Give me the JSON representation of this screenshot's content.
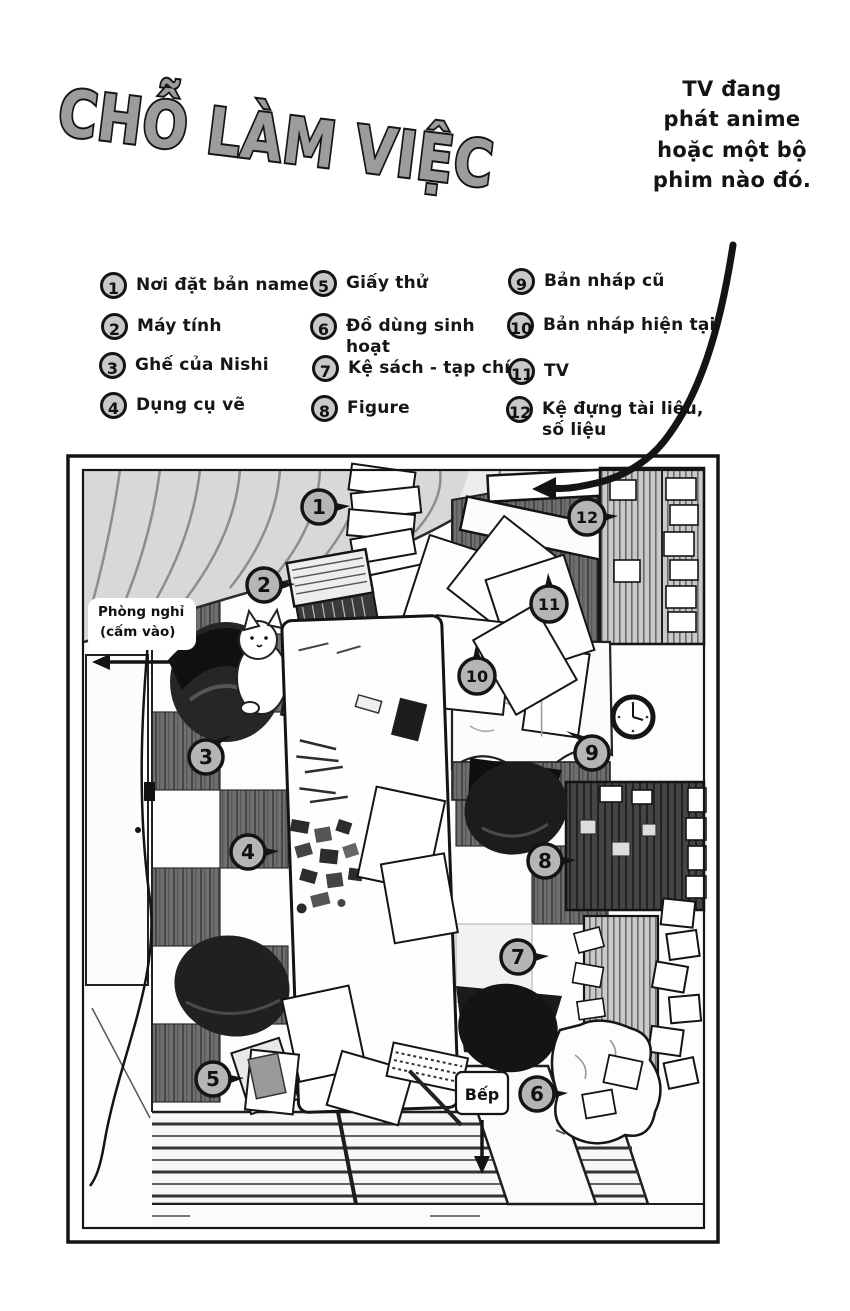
{
  "page": {
    "title": "CHỖ LÀM VIỆC",
    "annotation": "TV đang\nphát anime\nhoặc một bộ\nphim nào đó."
  },
  "legend": {
    "items": [
      {
        "num": "1",
        "label": "Nơi đặt bản name"
      },
      {
        "num": "2",
        "label": "Máy tính"
      },
      {
        "num": "3",
        "label": "Ghế của Nishi"
      },
      {
        "num": "4",
        "label": "Dụng cụ vẽ"
      },
      {
        "num": "5",
        "label": "Giấy thử"
      },
      {
        "num": "6",
        "label": "Đồ dùng sinh hoạt"
      },
      {
        "num": "7",
        "label": "Kệ sách - tạp chí"
      },
      {
        "num": "8",
        "label": "Figure"
      },
      {
        "num": "9",
        "label": "Bản nháp cũ"
      },
      {
        "num": "10",
        "label": "Bản nháp hiện tại"
      },
      {
        "num": "11",
        "label": "TV"
      },
      {
        "num": "12",
        "label": "Kệ đựng tài liệu, số liệu"
      }
    ]
  },
  "map": {
    "rest_room_label_line1": "Phòng nghỉ",
    "rest_room_label_line2": "(cấm vào)",
    "kitchen_label": "Bếp",
    "nameplate": "Nishi"
  },
  "colors": {
    "ink": "#161616",
    "title_fill": "#9c9c9c",
    "marker_fill": "#b5b5b5",
    "curtain_gray": "#d8d8d8",
    "dark_wood": "#6f6f6f"
  }
}
